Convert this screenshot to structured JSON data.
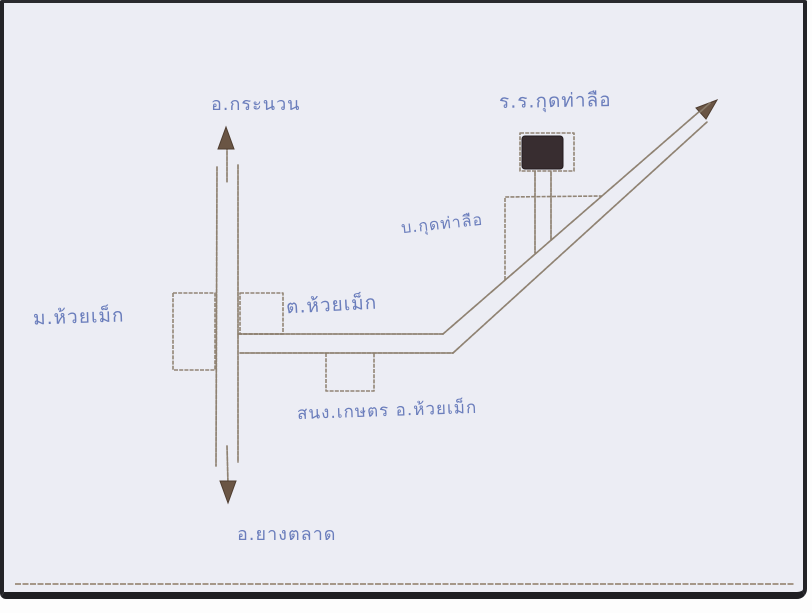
{
  "map": {
    "labels": {
      "district_north": "อ.กระนวน",
      "school": "ร.ร.กุดท่าลือ",
      "village_kut_tha_lue": "บ.กุดท่าลือ",
      "village_huai_mek": "ม.ห้วยเม็ก",
      "subdistrict_huai_mek": "ต.ห้วยเม็ก",
      "agriculture_office": "สนง.เกษตร อ.ห้วยเม็ก",
      "district_south": "อ.ยางตลาด"
    },
    "icons": {
      "north_arrow": "arrow-up-icon",
      "south_arrow": "arrow-down-icon",
      "northeast_arrow": "arrow-up-right-icon",
      "school_building": "filled-building-marker"
    },
    "colors": {
      "paper": "#ecedf4",
      "frame": "#232327",
      "road_ink": "#8a7c6a",
      "handwriting_blue": "#5a6fb5",
      "building_fill": "#382d30",
      "footer_rule": "#8d7b64"
    }
  }
}
